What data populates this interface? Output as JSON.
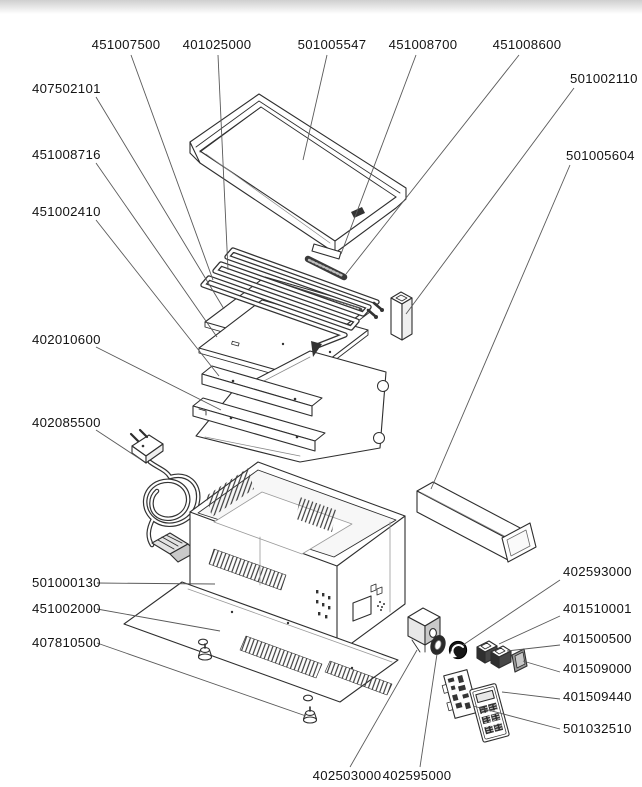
{
  "page": {
    "top_bar_color": "#cfcfcf",
    "background": "#ffffff"
  },
  "diagram": {
    "type": "exploded-parts-diagram",
    "subject": "griddle-appliance",
    "stroke_color": "#2e2e2e",
    "leader_color": "#5a5a5a",
    "label_color": "#141414",
    "label_font_size": 13.2,
    "labels": [
      {
        "text": "451007500",
        "anchor": "middle",
        "x": 126,
        "y": 49,
        "leader": {
          "x1": 131,
          "y1": 55,
          "x2": 213,
          "y2": 280
        },
        "part": "heating-element"
      },
      {
        "text": "401025000",
        "anchor": "middle",
        "x": 217,
        "y": 49,
        "leader": {
          "x1": 218,
          "y1": 55,
          "x2": 228,
          "y2": 270
        },
        "part": "heating-element-coil"
      },
      {
        "text": "501005547",
        "anchor": "middle",
        "x": 332,
        "y": 49,
        "leader": {
          "x1": 327,
          "y1": 55,
          "x2": 303,
          "y2": 160
        },
        "part": "griddle-plate"
      },
      {
        "text": "451008700",
        "anchor": "middle",
        "x": 423,
        "y": 49,
        "leader": {
          "x1": 416,
          "y1": 55,
          "x2": 341,
          "y2": 254
        },
        "part": "clamp-bar"
      },
      {
        "text": "451008600",
        "anchor": "middle",
        "x": 527,
        "y": 49,
        "leader": {
          "x1": 519,
          "y1": 55,
          "x2": 346,
          "y2": 274
        },
        "part": "clamp-bar-dark"
      },
      {
        "text": "501002110",
        "anchor": "start",
        "x": 570,
        "y": 83,
        "leader": {
          "x1": 574,
          "y1": 88,
          "x2": 406,
          "y2": 314
        },
        "part": "spacer-duct"
      },
      {
        "text": "501005604",
        "anchor": "start",
        "x": 566,
        "y": 160,
        "leader": {
          "x1": 570,
          "y1": 165,
          "x2": 431,
          "y2": 489
        },
        "part": "grease-drawer"
      },
      {
        "text": "407502101",
        "anchor": "start",
        "x": 32,
        "y": 93,
        "leader": {
          "x1": 96,
          "y1": 97,
          "x2": 224,
          "y2": 309
        },
        "part": "support-plate"
      },
      {
        "text": "451008716",
        "anchor": "start",
        "x": 32,
        "y": 159,
        "leader": {
          "x1": 96,
          "y1": 163,
          "x2": 217,
          "y2": 337
        },
        "part": "reflector-plate"
      },
      {
        "text": "451002410",
        "anchor": "start",
        "x": 32,
        "y": 216,
        "leader": {
          "x1": 96,
          "y1": 220,
          "x2": 219,
          "y2": 376
        },
        "part": "support-rail-upper"
      },
      {
        "text": "402010600",
        "anchor": "start",
        "x": 32,
        "y": 344,
        "leader": {
          "x1": 96,
          "y1": 347,
          "x2": 221,
          "y2": 410
        },
        "part": "support-rail-lower"
      },
      {
        "text": "402085500",
        "anchor": "start",
        "x": 32,
        "y": 427,
        "leader": {
          "x1": 96,
          "y1": 430,
          "x2": 140,
          "y2": 459
        },
        "part": "power-cord"
      },
      {
        "text": "501000130",
        "anchor": "start",
        "x": 32,
        "y": 587,
        "leader": {
          "x1": 97,
          "y1": 583,
          "x2": 215,
          "y2": 584
        },
        "part": "housing-body"
      },
      {
        "text": "451002000",
        "anchor": "start",
        "x": 32,
        "y": 613,
        "leader": {
          "x1": 97,
          "y1": 609,
          "x2": 220,
          "y2": 631
        },
        "part": "bottom-panel"
      },
      {
        "text": "407810500",
        "anchor": "start",
        "x": 32,
        "y": 647,
        "leader": {
          "x1": 97,
          "y1": 643,
          "x2": 306,
          "y2": 716
        },
        "part": "foot"
      },
      {
        "text": "402593000",
        "anchor": "start",
        "x": 563,
        "y": 576,
        "leader": {
          "x1": 560,
          "y1": 580,
          "x2": 463,
          "y2": 645
        },
        "part": "knob"
      },
      {
        "text": "401510001",
        "anchor": "start",
        "x": 563,
        "y": 613,
        "leader": {
          "x1": 560,
          "y1": 616,
          "x2": 499,
          "y2": 644
        },
        "part": "rocker-switch-left"
      },
      {
        "text": "401500500",
        "anchor": "start",
        "x": 563,
        "y": 643,
        "leader": {
          "x1": 560,
          "y1": 645,
          "x2": 507,
          "y2": 651
        },
        "part": "rocker-switch-right"
      },
      {
        "text": "401509000",
        "anchor": "start",
        "x": 563,
        "y": 673,
        "leader": {
          "x1": 560,
          "y1": 672,
          "x2": 523,
          "y2": 661
        },
        "part": "switch-cap"
      },
      {
        "text": "401509440",
        "anchor": "start",
        "x": 563,
        "y": 701,
        "leader": {
          "x1": 560,
          "y1": 699,
          "x2": 502,
          "y2": 692
        },
        "part": "control-panel-overlay"
      },
      {
        "text": "501032510",
        "anchor": "start",
        "x": 563,
        "y": 733,
        "leader": {
          "x1": 560,
          "y1": 729,
          "x2": 473,
          "y2": 706
        },
        "part": "control-pcb"
      },
      {
        "text": "402503000",
        "anchor": "middle",
        "x": 347,
        "y": 780,
        "leader": {
          "x1": 350,
          "y1": 767,
          "x2": 417,
          "y2": 650
        },
        "part": "thermostat"
      },
      {
        "text": "402595000",
        "anchor": "middle",
        "x": 417,
        "y": 780,
        "leader": {
          "x1": 420,
          "y1": 767,
          "x2": 437,
          "y2": 654
        },
        "part": "knob-bezel"
      }
    ]
  }
}
